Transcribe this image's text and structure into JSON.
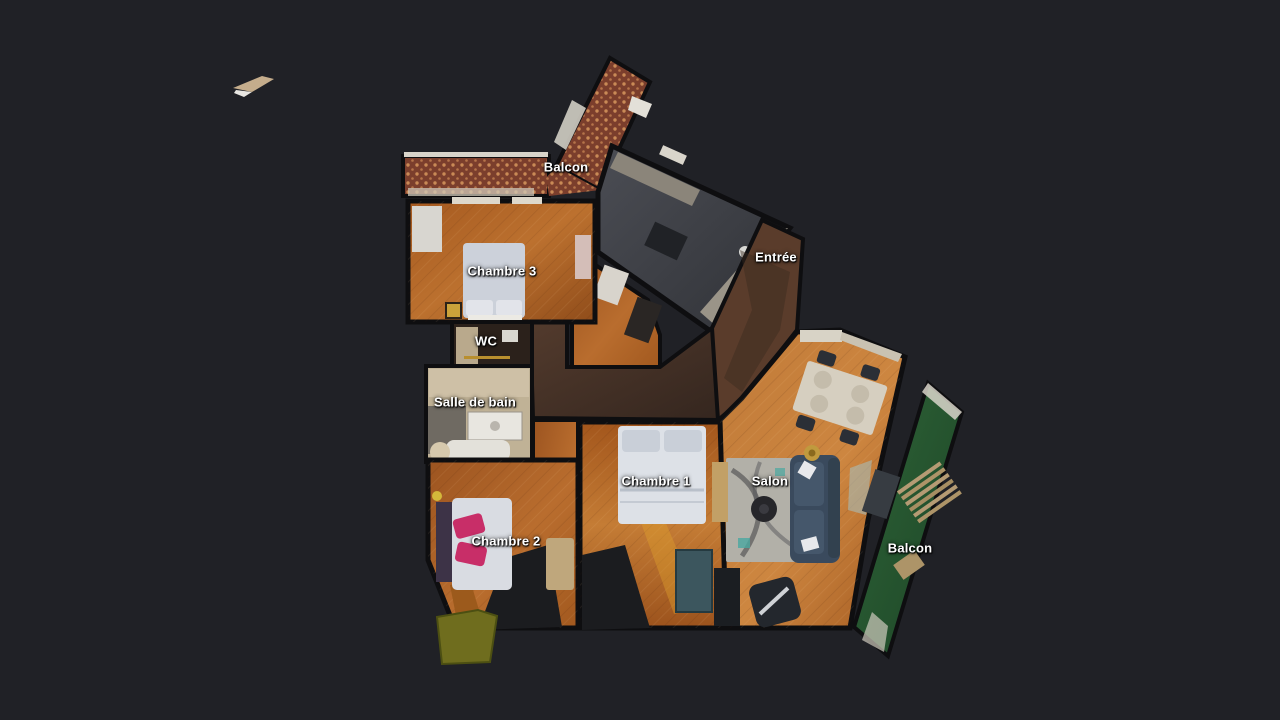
{
  "scene": {
    "app_view": "3D dollhouse floor plan",
    "background_color": "#202126"
  },
  "floorplan": {
    "labels": [
      {
        "id": "balcon-top",
        "text": "Balcon"
      },
      {
        "id": "chambre-3",
        "text": "Chambre 3"
      },
      {
        "id": "wc",
        "text": "WC"
      },
      {
        "id": "salle-de-bain",
        "text": "Salle de bain"
      },
      {
        "id": "chambre-2",
        "text": "Chambre 2"
      },
      {
        "id": "chambre-1",
        "text": "Chambre 1"
      },
      {
        "id": "entree",
        "text": "Entrée"
      },
      {
        "id": "salon",
        "text": "Salon"
      },
      {
        "id": "balcon-right",
        "text": "Balcon"
      }
    ],
    "colors": {
      "background": "#202126",
      "label_text": "#ffffff",
      "wood_floor": "#b4682a",
      "wood_floor_dark": "#8f4c1a",
      "corridor": "#46302a",
      "entree_floor": "#5a3c2b",
      "kitchen_floor": "#45474d",
      "kitchen_counter": "#a09a8d",
      "balcony_tile": "#7b3e2c",
      "balcony_tile_dot": "#c98a56",
      "balcony_green": "#2c5c35",
      "bathroom_floor": "#c0b296",
      "wc_floor": "#2b211b",
      "bed_white": "#d3d7de",
      "sofa_blue": "#3c4d60",
      "rug_gray": "#b2b0a8",
      "pillow_pink": "#c82e68",
      "wardrobe_teal": "#3c565e",
      "terrace_olive": "#6f6d1e",
      "wall": "#0e0e10"
    }
  }
}
